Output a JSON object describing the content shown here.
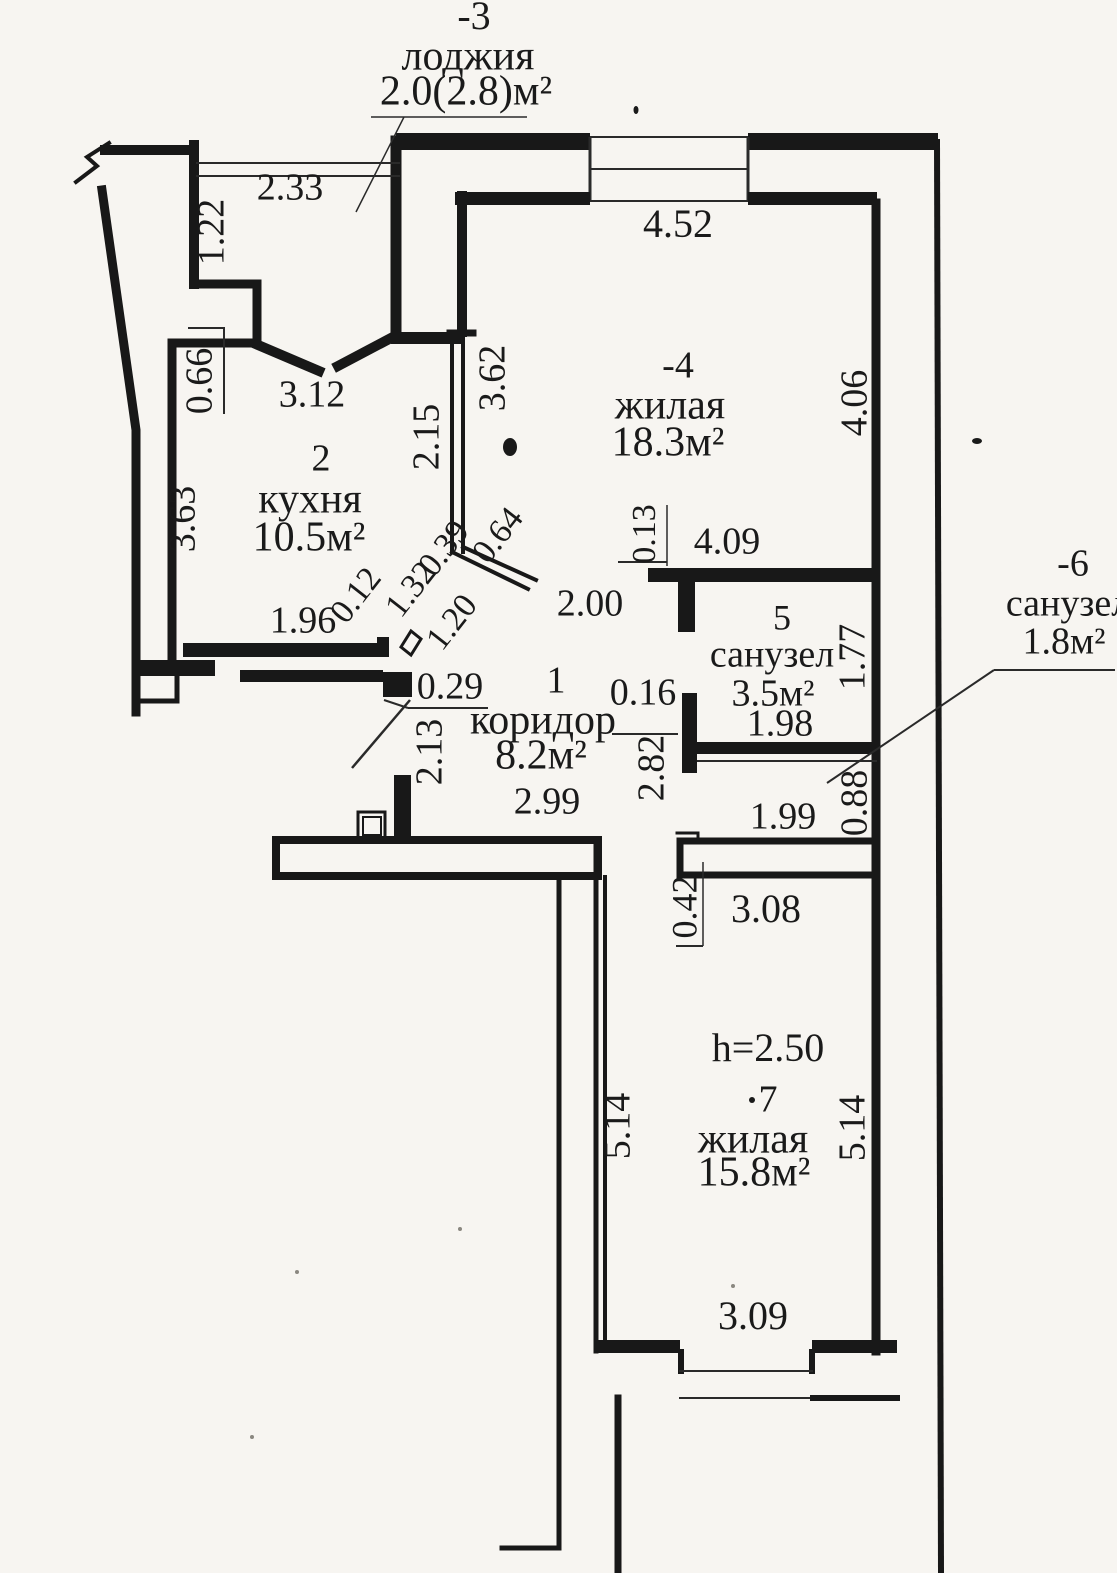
{
  "document": {
    "kind": "apartment floor plan (scanned technical drawing)",
    "language": "ru",
    "ceiling_height_note": "h=2.50"
  },
  "colors": {
    "ink": "#1a1a1a",
    "paper": "#f7f5f1"
  },
  "plan": {
    "rooms_summary": [
      {
        "number": "-3",
        "name": "лоджия",
        "area": "2.0(2.8)м²"
      },
      {
        "number": "2",
        "name": "кухня",
        "area": "10.5м²"
      },
      {
        "number": "-4",
        "name": "жилая",
        "area": "18.3м²"
      },
      {
        "number": "5",
        "name": "санузел",
        "area": "3.5м²"
      },
      {
        "number": "-6",
        "name": "санузел",
        "area": "1.8м²"
      },
      {
        "number": "1",
        "name": "коридор",
        "area": "8.2м²"
      },
      {
        "number": "7",
        "name": "жилая",
        "area": "15.8м²"
      }
    ],
    "labels": [
      {
        "name": "room-loggia-number",
        "text": "-3",
        "x": 474,
        "y": 20,
        "r": 0,
        "s": 40
      },
      {
        "name": "room-loggia-name",
        "text": "лоджия",
        "x": 468,
        "y": 60,
        "r": 0,
        "s": 42
      },
      {
        "name": "room-loggia-area",
        "text": "2.0(2.8)м²",
        "x": 466,
        "y": 95,
        "r": 0,
        "s": 42
      },
      {
        "name": "dim-2-33",
        "text": "2.33",
        "x": 290,
        "y": 191,
        "r": 0,
        "s": 38
      },
      {
        "name": "dim-1-22",
        "text": "1.22",
        "x": 215,
        "y": 232,
        "r": -90,
        "s": 38
      },
      {
        "name": "dim-0-66",
        "text": "0.66",
        "x": 203,
        "y": 381,
        "r": -90,
        "s": 38
      },
      {
        "name": "dim-3-12",
        "text": "3.12",
        "x": 312,
        "y": 398,
        "r": 0,
        "s": 38
      },
      {
        "name": "room-kitchen-number",
        "text": "2",
        "x": 321,
        "y": 462,
        "r": 0,
        "s": 38
      },
      {
        "name": "room-kitchen-name",
        "text": "кухня",
        "x": 310,
        "y": 503,
        "r": 0,
        "s": 42
      },
      {
        "name": "room-kitchen-area",
        "text": "10.5м²",
        "x": 309,
        "y": 541,
        "r": 0,
        "s": 42
      },
      {
        "name": "dim-3-63",
        "text": "3.63",
        "x": 186,
        "y": 519,
        "r": -90,
        "s": 38
      },
      {
        "name": "dim-2-15",
        "text": "2.15",
        "x": 430,
        "y": 437,
        "r": -90,
        "s": 38
      },
      {
        "name": "dim-3-62",
        "text": "3.62",
        "x": 496,
        "y": 378,
        "r": -90,
        "s": 38
      },
      {
        "name": "dim-4-52",
        "text": "4.52",
        "x": 678,
        "y": 228,
        "r": 0,
        "s": 40
      },
      {
        "name": "room-living1-number",
        "text": "-4",
        "x": 678,
        "y": 369,
        "r": 0,
        "s": 38
      },
      {
        "name": "room-living1-name",
        "text": "жилая",
        "x": 670,
        "y": 409,
        "r": 0,
        "s": 42
      },
      {
        "name": "room-living1-area",
        "text": "18.3м²",
        "x": 668,
        "y": 446,
        "r": 0,
        "s": 42
      },
      {
        "name": "dim-4-06",
        "text": "4.06",
        "x": 858,
        "y": 403,
        "r": -90,
        "s": 38
      },
      {
        "name": "dim-0-64",
        "text": "0.64",
        "x": 500,
        "y": 537,
        "r": -52,
        "s": 34
      },
      {
        "name": "dim-0-39",
        "text": "0.39",
        "x": 446,
        "y": 550,
        "r": -52,
        "s": 34
      },
      {
        "name": "dim-1-32",
        "text": "1.32",
        "x": 413,
        "y": 591,
        "r": -52,
        "s": 34
      },
      {
        "name": "dim-0-12",
        "text": "0.12",
        "x": 358,
        "y": 597,
        "r": -52,
        "s": 34
      },
      {
        "name": "dim-1-20",
        "text": "1.20",
        "x": 454,
        "y": 624,
        "r": -52,
        "s": 34
      },
      {
        "name": "dim-1-96",
        "text": "1.96",
        "x": 303,
        "y": 624,
        "r": 0,
        "s": 38
      },
      {
        "name": "dim-0-29",
        "text": "0.29",
        "x": 450,
        "y": 690,
        "r": 0,
        "s": 38
      },
      {
        "name": "dim-2-00",
        "text": "2.00",
        "x": 590,
        "y": 607,
        "r": 0,
        "s": 38
      },
      {
        "name": "dim-0-13",
        "text": "0.13",
        "x": 647,
        "y": 534,
        "r": -90,
        "s": 34
      },
      {
        "name": "dim-4-09",
        "text": "4.09",
        "x": 727,
        "y": 545,
        "r": 0,
        "s": 38
      },
      {
        "name": "room-bath1-number",
        "text": "5",
        "x": 782,
        "y": 621,
        "r": 0,
        "s": 36
      },
      {
        "name": "room-bath1-name",
        "text": "санузел",
        "x": 772,
        "y": 658,
        "r": 0,
        "s": 38
      },
      {
        "name": "room-bath1-area",
        "text": "3.5м²",
        "x": 773,
        "y": 697,
        "r": 0,
        "s": 38
      },
      {
        "name": "dim-1-77",
        "text": "1.77",
        "x": 856,
        "y": 657,
        "r": -90,
        "s": 38
      },
      {
        "name": "dim-0-16",
        "text": "0.16",
        "x": 643,
        "y": 696,
        "r": 0,
        "s": 38
      },
      {
        "name": "dim-1-98",
        "text": "1.98",
        "x": 780,
        "y": 727,
        "r": 0,
        "s": 38
      },
      {
        "name": "dim-2-82",
        "text": "2.82",
        "x": 655,
        "y": 768,
        "r": -90,
        "s": 38
      },
      {
        "name": "room-corridor-number",
        "text": "1",
        "x": 556,
        "y": 684,
        "r": 0,
        "s": 38
      },
      {
        "name": "room-corridor-name",
        "text": "коридор",
        "x": 543,
        "y": 724,
        "r": 0,
        "s": 42
      },
      {
        "name": "room-corridor-area",
        "text": "8.2м²",
        "x": 541,
        "y": 759,
        "r": 0,
        "s": 42
      },
      {
        "name": "dim-2-99",
        "text": "2.99",
        "x": 547,
        "y": 805,
        "r": 0,
        "s": 38
      },
      {
        "name": "dim-2-13",
        "text": "2.13",
        "x": 433,
        "y": 752,
        "r": -90,
        "s": 38
      },
      {
        "name": "dim-1-99",
        "text": "1.99",
        "x": 783,
        "y": 820,
        "r": 0,
        "s": 38
      },
      {
        "name": "dim-0-88",
        "text": "0.88",
        "x": 858,
        "y": 803,
        "r": -90,
        "s": 38
      },
      {
        "name": "room-bath2-number",
        "text": "-6",
        "x": 1073,
        "y": 567,
        "r": 0,
        "s": 38
      },
      {
        "name": "room-bath2-name",
        "text": "санузел",
        "x": 1068,
        "y": 607,
        "r": 0,
        "s": 38
      },
      {
        "name": "room-bath2-area",
        "text": "1.8м²",
        "x": 1064,
        "y": 645,
        "r": 0,
        "s": 38
      },
      {
        "name": "dim-0-42",
        "text": "0.42",
        "x": 688,
        "y": 907,
        "r": -90,
        "s": 36
      },
      {
        "name": "dim-3-08",
        "text": "3.08",
        "x": 766,
        "y": 913,
        "r": 0,
        "s": 40
      },
      {
        "name": "ceiling-height",
        "text": "h=2.50",
        "x": 768,
        "y": 1052,
        "r": 0,
        "s": 40
      },
      {
        "name": "room-living2-number",
        "text": "7",
        "x": 768,
        "y": 1103,
        "r": 0,
        "s": 38
      },
      {
        "name": "room-living2-name",
        "text": "жилая",
        "x": 753,
        "y": 1143,
        "r": 0,
        "s": 42
      },
      {
        "name": "room-living2-area",
        "text": "15.8м²",
        "x": 754,
        "y": 1176,
        "r": 0,
        "s": 42
      },
      {
        "name": "dim-5-14-left",
        "text": "5.14",
        "x": 621,
        "y": 1126,
        "r": -90,
        "s": 38
      },
      {
        "name": "dim-5-14-right",
        "text": "5.14",
        "x": 856,
        "y": 1128,
        "r": -90,
        "s": 38
      },
      {
        "name": "dim-3-09",
        "text": "3.09",
        "x": 753,
        "y": 1320,
        "r": 0,
        "s": 40
      }
    ]
  }
}
